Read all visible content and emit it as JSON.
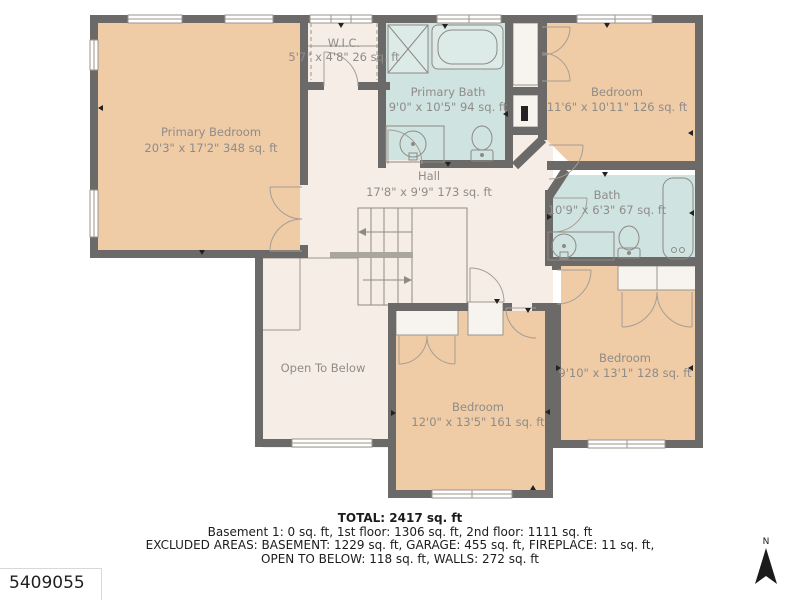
{
  "meta": {
    "listing_id": "5409055",
    "compass_label": "N"
  },
  "rooms": [
    {
      "name": "Primary Bedroom",
      "dims": "20'3\" x 17'2\" 348 sq. ft"
    },
    {
      "name": "W.I.C.",
      "dims": "5'7\" x 4'8\" 26 sq. ft"
    },
    {
      "name": "Primary Bath",
      "dims": "9'0\" x 10'5\" 94 sq. ft"
    },
    {
      "name": "Bedroom",
      "dims": "11'6\" x 10'11\" 126 sq. ft"
    },
    {
      "name": "Hall",
      "dims": "17'8\" x 9'9\" 173 sq. ft"
    },
    {
      "name": "Bath",
      "dims": "10'9\" x 6'3\" 67 sq. ft"
    },
    {
      "name": "Bedroom",
      "dims": "9'10\" x 13'1\" 128 sq. ft"
    },
    {
      "name": "Bedroom",
      "dims": "12'0\" x 13'5\" 161 sq. ft"
    },
    {
      "name": "Open To Below",
      "dims": ""
    }
  ],
  "summary": {
    "total": "TOTAL: 2417 sq. ft",
    "floors": "Basement 1: 0 sq. ft, 1st floor: 1306 sq. ft, 2nd floor: 1111 sq. ft",
    "excluded1": "EXCLUDED AREAS: BASEMENT: 1229 sq. ft, GARAGE: 455 sq. ft, FIREPLACE: 11 sq. ft,",
    "excluded2": "OPEN TO BELOW: 118 sq. ft, WALLS: 272 sq. ft"
  },
  "colors": {
    "bedroom_fill": "#efcba6",
    "bath_fill": "#cfe3e1",
    "hall_fill": "#f6ede7",
    "closet_fill": "#f7f3ee",
    "wall": "#6b6a68",
    "label_text": "#8f8c88",
    "summary_text": "#1c1c1c"
  }
}
